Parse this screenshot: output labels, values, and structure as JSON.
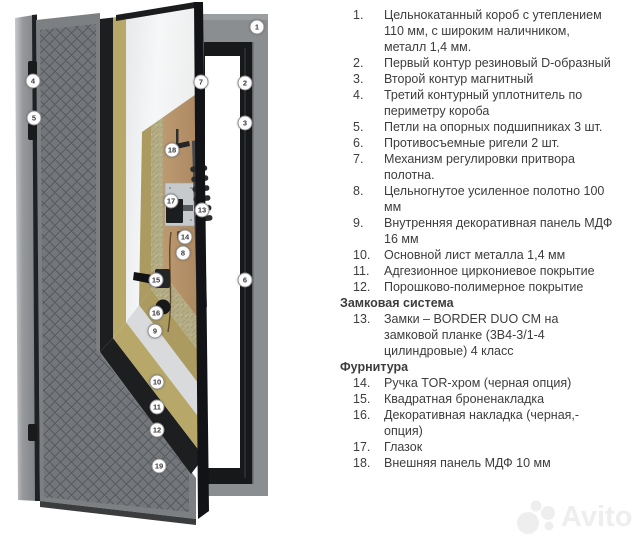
{
  "watermark": {
    "brand": "Avito"
  },
  "diagram": {
    "description": "Cutaway diagram of a steel entrance door with numbered callouts",
    "callouts": [
      {
        "n": "1",
        "x": 257,
        "y": 27
      },
      {
        "n": "2",
        "x": 245,
        "y": 83
      },
      {
        "n": "3",
        "x": 245,
        "y": 123
      },
      {
        "n": "4",
        "x": 33,
        "y": 81
      },
      {
        "n": "5",
        "x": 34,
        "y": 118
      },
      {
        "n": "6",
        "x": 245,
        "y": 280
      },
      {
        "n": "7",
        "x": 201,
        "y": 82
      },
      {
        "n": "8",
        "x": 183,
        "y": 253
      },
      {
        "n": "9",
        "x": 155,
        "y": 331
      },
      {
        "n": "10",
        "x": 157,
        "y": 382
      },
      {
        "n": "11",
        "x": 157,
        "y": 407
      },
      {
        "n": "12",
        "x": 157,
        "y": 430
      },
      {
        "n": "13",
        "x": 202,
        "y": 210
      },
      {
        "n": "14",
        "x": 185,
        "y": 237
      },
      {
        "n": "15",
        "x": 156,
        "y": 280
      },
      {
        "n": "16",
        "x": 156,
        "y": 313
      },
      {
        "n": "17",
        "x": 171,
        "y": 201
      },
      {
        "n": "18",
        "x": 172,
        "y": 150
      },
      {
        "n": "19",
        "x": 159,
        "y": 466
      }
    ],
    "colors": {
      "quilt_panel": "#73767a",
      "frame_gray": "#8b8e91",
      "metal_black": "#17181a",
      "gold_layer": "#b7a768",
      "white_panel": "#f4f5f6",
      "mineral_wool": "#b4ac84",
      "wood_panel": "#b6936b"
    }
  },
  "specs": {
    "rows": [
      {
        "num": "1.",
        "text": "Цельнокатанный короб с утеплением 110 мм, с широким наличником, металл 1,4 мм."
      },
      {
        "num": "2.",
        "text": "Первый контур резиновый D-образный"
      },
      {
        "num": "3.",
        "text": "Второй контур магнитный"
      },
      {
        "num": "4.",
        "text": "Третий контурный уплотнитель по периметру короба"
      },
      {
        "num": "5.",
        "text": "Петли на опорных подшипниках 3 шт."
      },
      {
        "num": "6.",
        "text": "Противосъемные ригели 2 шт."
      },
      {
        "num": "7.",
        "text": "Механизм регулировки притвора полотна."
      },
      {
        "num": "8.",
        "text": "Цельногнутое усиленное полотно 100 мм"
      },
      {
        "num": "9.",
        "text": "Внутренняя декоративная панель МДФ 16 мм"
      },
      {
        "num": "10.",
        "text": "Основной лист металла 1,4 мм"
      },
      {
        "num": "11.",
        "text": "Адгезионное циркониевое покрытие"
      },
      {
        "num": "12.",
        "text": "Порошково-полимерное покрытие"
      },
      {
        "heading": true,
        "text": "Замковая система"
      },
      {
        "num": "13.",
        "text": "Замки – BORDER DUO CM на замковой планке (3В4-3/1-4 цилиндровые) 4 класс"
      },
      {
        "heading": true,
        "text": "Фурнитура"
      },
      {
        "num": "14.",
        "text": "Ручка TOR-хром (черная опция)"
      },
      {
        "num": "15.",
        "text": "Квадратная броненакладка"
      },
      {
        "num": "16.",
        "text": "Декоративная накладка (черная,- опция)"
      },
      {
        "num": "17.",
        "text": "Глазок"
      },
      {
        "num": "18.",
        "text": "Внешняя панель МДФ 10 мм"
      }
    ]
  }
}
